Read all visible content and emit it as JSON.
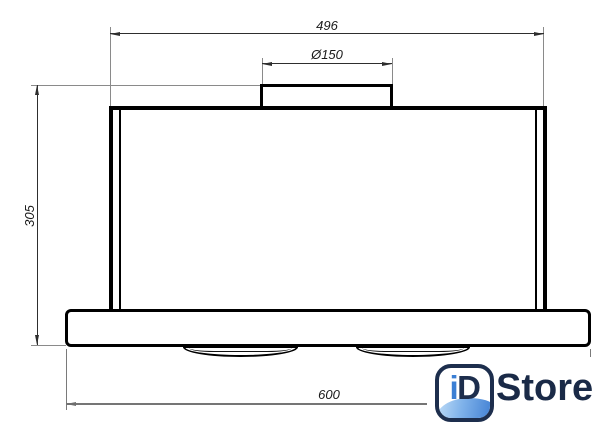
{
  "drawing": {
    "title": "built-in cooker hood dimension drawing",
    "dims": {
      "top_width": "496",
      "duct_diameter": "Ø150",
      "height": "305",
      "bottom_width": "600"
    },
    "colors": {
      "outline": "#000000",
      "dimension_line": "#2e2e2e",
      "extension_line": "#8a8a8a"
    }
  },
  "logo": {
    "icon_i": "i",
    "icon_d": "D",
    "wordmark": "Store",
    "navy": "#1d2e4d",
    "blue": "#3b7fd4"
  }
}
